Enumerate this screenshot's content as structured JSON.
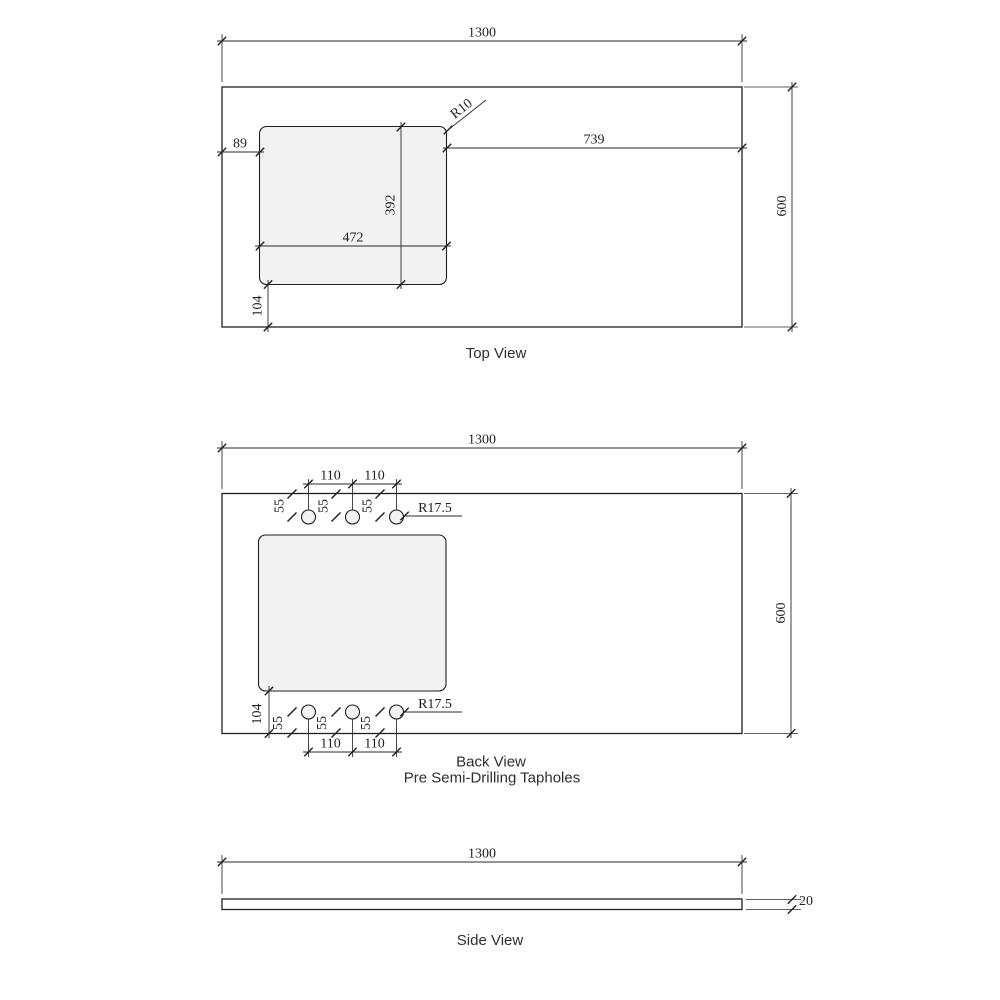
{
  "drawing": {
    "colors": {
      "line": "#1f1f1f",
      "dim": "#2a2a2a",
      "fill_light": "#f2f2f2",
      "background": "#ffffff"
    },
    "top_view": {
      "label": "Top View",
      "width": "1300",
      "height": "600",
      "offset_left": "89",
      "offset_right": "739",
      "cutout_width": "472",
      "cutout_height": "392",
      "offset_bottom": "104",
      "corner_radius": "R10"
    },
    "back_view": {
      "label": "Back View",
      "sublabel": "Pre Semi-Drilling Tapholes",
      "width": "1300",
      "height": "600",
      "hole_spacing": "110",
      "edge_to_hole": "55",
      "hole_radius": "R17.5",
      "offset_bottom": "104"
    },
    "side_view": {
      "label": "Side View",
      "width": "1300",
      "thickness": "20"
    }
  }
}
